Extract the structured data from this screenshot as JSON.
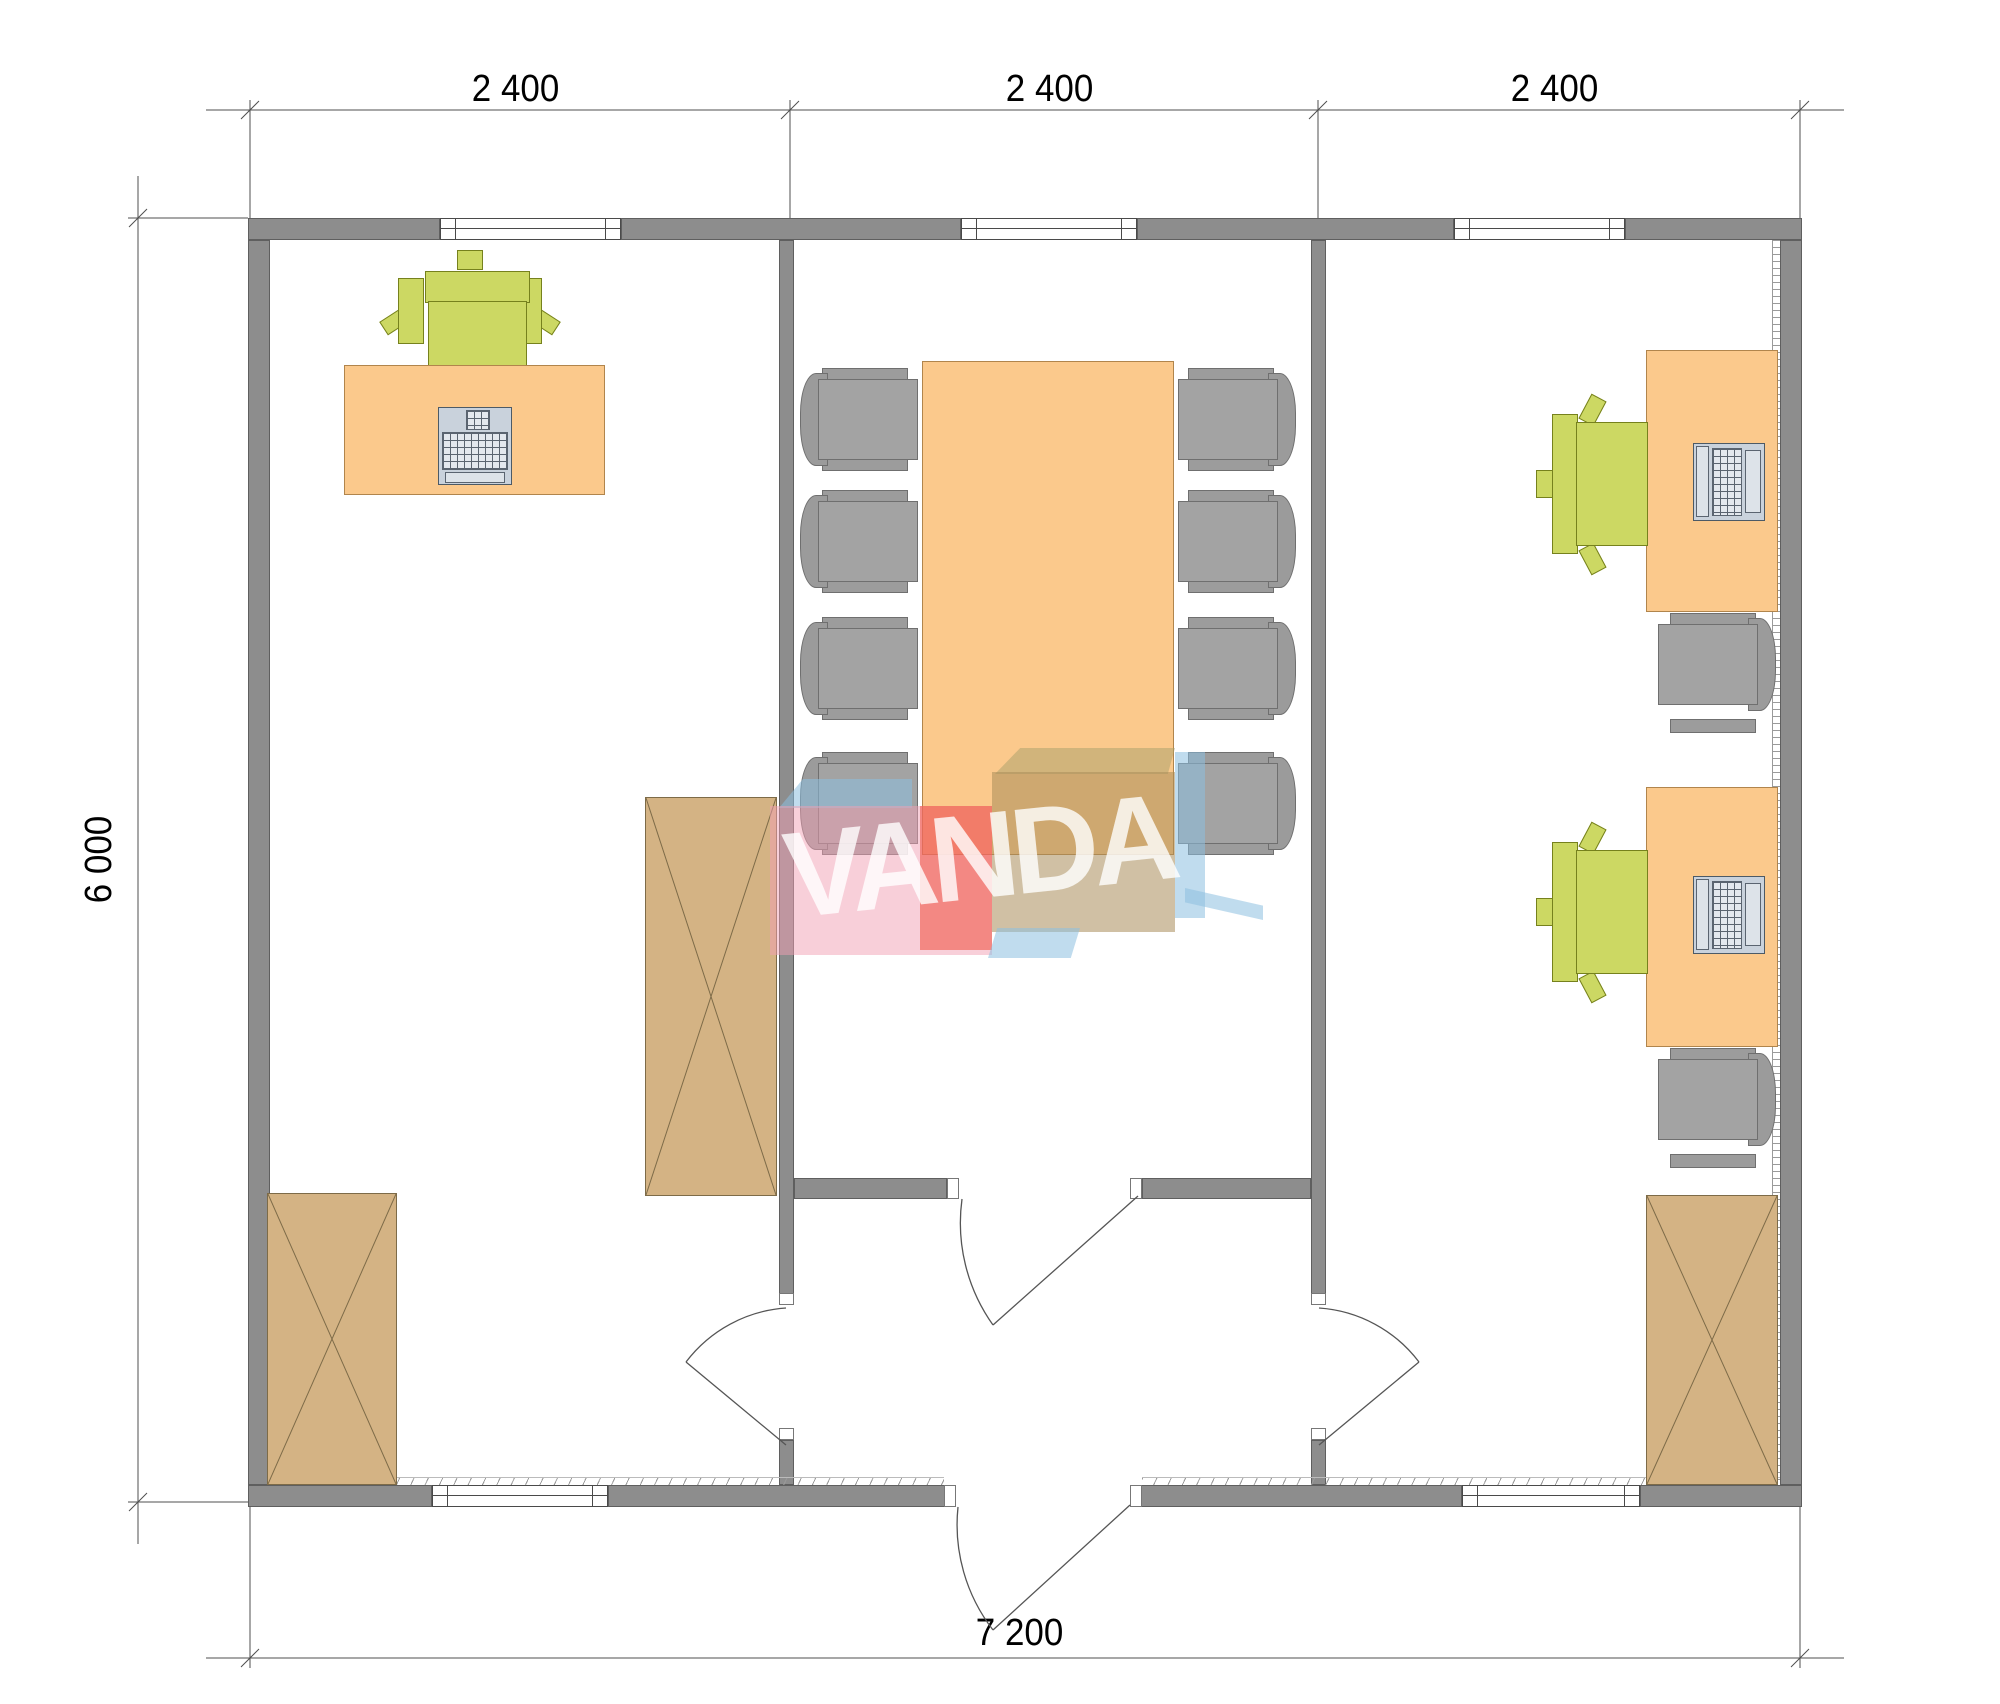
{
  "watermark": {
    "text": "VANDA"
  },
  "dimensions": {
    "top_segments": [
      "2 400",
      "2 400",
      "2 400"
    ],
    "left_total": "6 000",
    "bottom_total": "7 200"
  },
  "colors": {
    "wall": "#8d8d8d",
    "wall_edge": "#5f5f5f",
    "desk": "#fbc98c",
    "desk_edge": "#b1854c",
    "chair_green": "#ccd863",
    "chair_green_edge": "#76811d",
    "chair_gray": "#a3a3a3",
    "chair_gray_edge": "#6f6f6f",
    "cabinet": "#d4b384",
    "cabinet_edge": "#7d6b48",
    "laptop": "#c9d2dc",
    "laptop_edge": "#4c5a66",
    "logo_blue": "#8cc0e0",
    "logo_pink": "#f2a0b4",
    "logo_red": "#ee4e3c",
    "logo_tan": "#a98c5a",
    "logo_olive": "#a8a06a",
    "logo_text": "#ffffff"
  }
}
